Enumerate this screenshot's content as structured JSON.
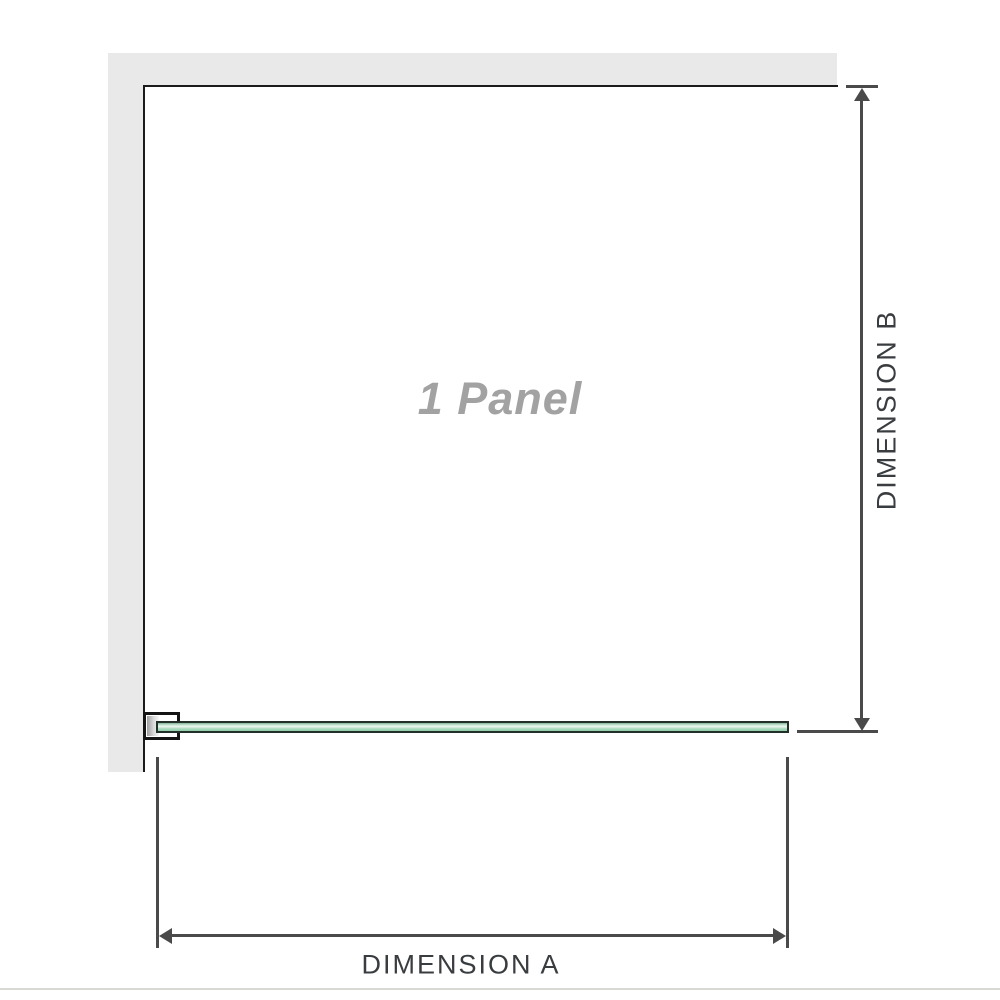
{
  "diagram": {
    "panel_label": "1 Panel",
    "dimension_a": {
      "label": "DIMENSION A",
      "orientation": "horizontal"
    },
    "dimension_b": {
      "label": "DIMENSION B",
      "orientation": "vertical"
    }
  },
  "colors": {
    "background": "#ffffff",
    "wall": "#e9e9e9",
    "panel_outline": "#1b1b1b",
    "dimension_line": "#4a4a4a",
    "dimension_text": "#3a3d40",
    "panel_label_text": "#a2a2a2",
    "glass_edge": "#233029",
    "glass_top": "#86b699",
    "glass_highlight": "#ecf7f0",
    "glass_bottom": "#8fcdaa",
    "bracket_outline": "#141414",
    "bracket_pad": "#9e9e9e",
    "bottom_divider": "#d9d9d3"
  }
}
